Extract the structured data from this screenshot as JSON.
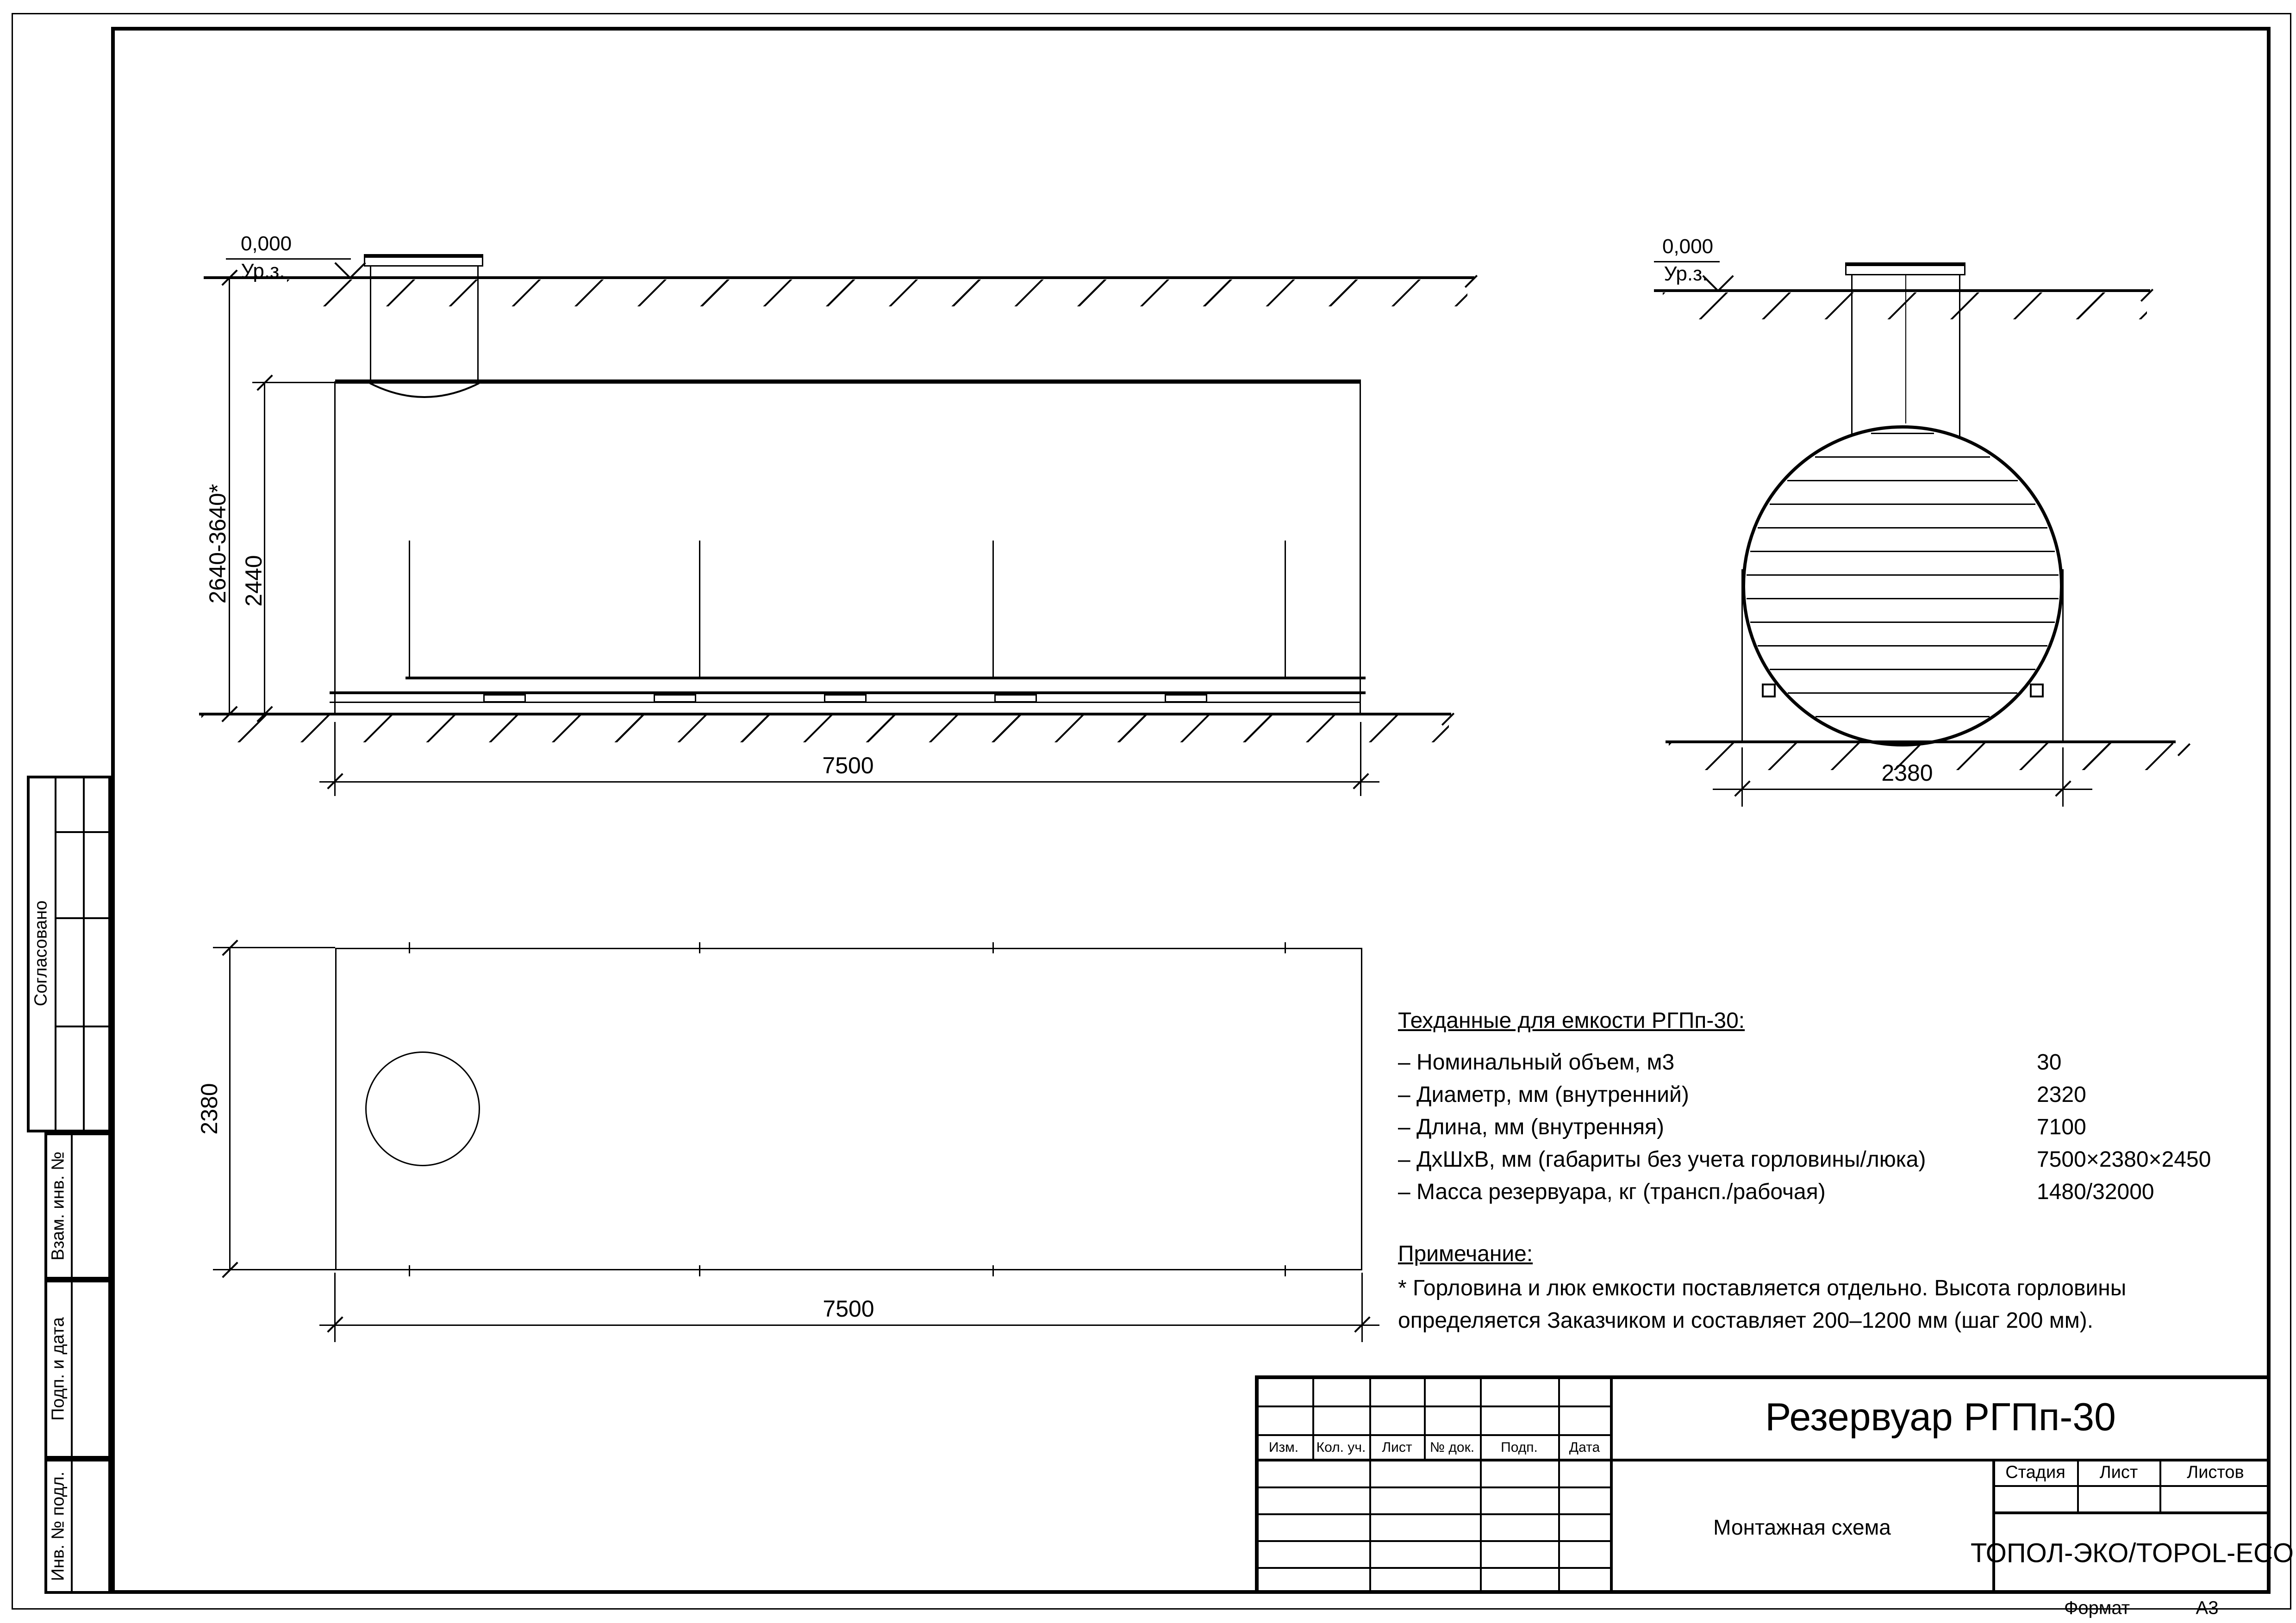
{
  "colors": {
    "ink": "#000000",
    "paper": "#ffffff"
  },
  "views": {
    "elevation": {
      "level_value": "0,000",
      "level_label": "Ур.з.",
      "dim_depth": "2640-3640*",
      "dim_body_height": "2440",
      "dim_length": "7500"
    },
    "cross_section": {
      "level_value": "0,000",
      "level_label": "Ур.з.",
      "dim_width": "2380"
    },
    "plan": {
      "dim_width": "2380",
      "dim_length": "7500"
    }
  },
  "tech_data": {
    "title": "Техданные для емкости РГПп-30:",
    "rows": [
      {
        "label": "– Номинальный объем, м3",
        "value": "30"
      },
      {
        "label": "– Диаметр, мм (внутренний)",
        "value": "2320"
      },
      {
        "label": "– Длина, мм (внутренняя)",
        "value": "7100"
      },
      {
        "label": "– ДхШхВ, мм (габариты без учета горловины/люка)",
        "value": "7500×2380×2450"
      },
      {
        "label": "– Масса резервуара, кг (трансп./рабочая)",
        "value": "1480/32000"
      }
    ]
  },
  "note": {
    "title": "Примечание:",
    "line1": "* Горловина и люк емкости поставляется отдельно. Высота горловины",
    "line2": "определяется Заказчиком и составляет 200–1200 мм (шаг 200 мм)."
  },
  "title_block": {
    "doc_title": "Резервуар РГПп-30",
    "scheme_label": "Монтажная схема",
    "company": "ТОПОЛ-ЭКО/TOPOL-ECO",
    "header_cols": [
      "Изм.",
      "Кол. уч.",
      "Лист",
      "№ док.",
      "Подп.",
      "Дата"
    ],
    "stage_label": "Стадия",
    "sheet_label": "Лист",
    "sheets_label": "Листов",
    "format_label": "Формат",
    "format_value": "А3"
  },
  "sidebar": {
    "approved": "Согласовано",
    "replace_inv": "Взам. инв. №",
    "sign_date": "Подп. и дата",
    "inv_orig": "Инв. № подл."
  }
}
